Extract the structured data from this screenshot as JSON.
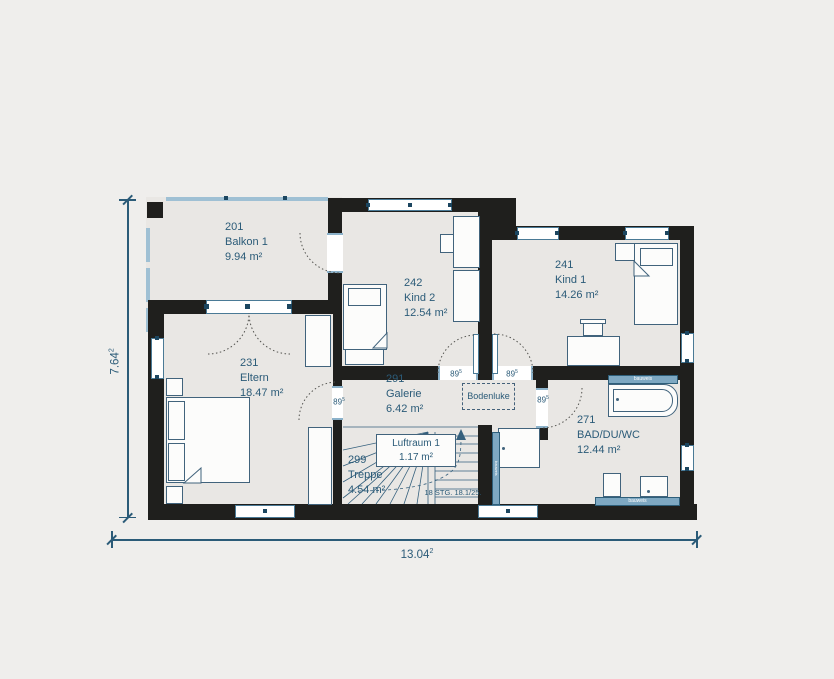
{
  "plan": {
    "rooms": {
      "balkon": {
        "number": "201",
        "name": "Balkon 1",
        "area": "9.94 m²"
      },
      "kind2": {
        "number": "242",
        "name": "Kind 2",
        "area": "12.54 m²"
      },
      "kind1": {
        "number": "241",
        "name": "Kind 1",
        "area": "14.26 m²"
      },
      "eltern": {
        "number": "231",
        "name": "Eltern",
        "area": "18.47 m²"
      },
      "galerie": {
        "number": "291",
        "name": "Galerie",
        "area": "6.42 m²"
      },
      "treppe": {
        "number": "299",
        "name": "Treppe",
        "area": "4.54 m²"
      },
      "bad": {
        "number": "271",
        "name": "BAD/DU/WC",
        "area": "12.44 m²"
      },
      "luftraum": {
        "name": "Luftraum 1",
        "area": "1.17 m²"
      }
    },
    "annotations": {
      "bodenluke": "Bodenluke",
      "stair_note": "18 STG. 18.1/25.",
      "door_width": {
        "value": "89",
        "sup": "5"
      },
      "fixture_label": "bauweis"
    },
    "dimensions": {
      "total_width": {
        "value": "13.04",
        "sup": "2"
      },
      "total_height": {
        "value": "7.64",
        "sup": "2"
      }
    },
    "colors": {
      "wall": "#1f1f1d",
      "accent_text": "#2b5b78",
      "light_blue": "#88aec8",
      "floor": "#e9e7e4",
      "background": "#efeeec"
    }
  }
}
